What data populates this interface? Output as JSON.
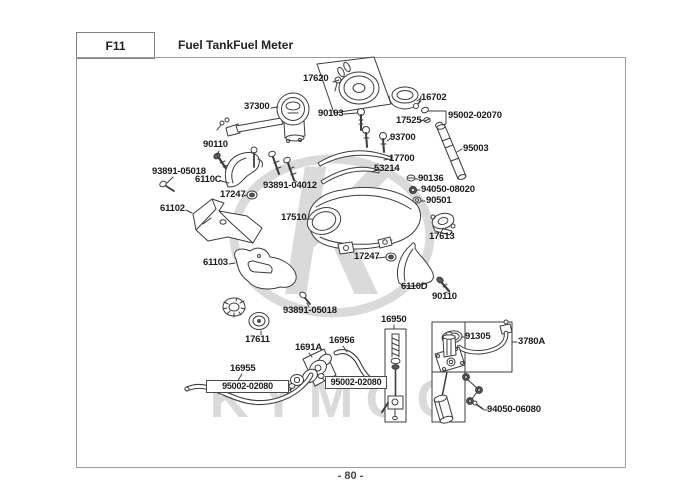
{
  "header": {
    "code": "F11",
    "title": "Fuel TankFuel Meter"
  },
  "footer": {
    "page_number": "- 80 -"
  },
  "watermark": {
    "logo_letter": "K",
    "logo_text": "KYMCO"
  },
  "colors": {
    "line": "#3c3c3c",
    "watermark": "#dadada",
    "label_text": "#1c1c1c"
  },
  "parts": [
    {
      "label": "17620"
    },
    {
      "label": "37300"
    },
    {
      "label": "90103"
    },
    {
      "label": "16702"
    },
    {
      "label": "17525"
    },
    {
      "label": "95002-02070"
    },
    {
      "label": "93700"
    },
    {
      "label": "95003"
    },
    {
      "label": "17700"
    },
    {
      "label": "53214"
    },
    {
      "label": "90136"
    },
    {
      "label": "94050-08020"
    },
    {
      "label": "90501"
    },
    {
      "label": "90110"
    },
    {
      "label": "93891-05018"
    },
    {
      "label": "6110C"
    },
    {
      "label": "93891-04012"
    },
    {
      "label": "17247"
    },
    {
      "label": "61102"
    },
    {
      "label": "17510"
    },
    {
      "label": "17613"
    },
    {
      "label": "17247"
    },
    {
      "label": "6110D"
    },
    {
      "label": "90110"
    },
    {
      "label": "61103"
    },
    {
      "label": "93891-05018"
    },
    {
      "label": "17611"
    },
    {
      "label": "16950"
    },
    {
      "label": "1691A"
    },
    {
      "label": "16956"
    },
    {
      "label": "95002-02080"
    },
    {
      "label": "95002-02080"
    },
    {
      "label": "16955"
    },
    {
      "label": "91305"
    },
    {
      "label": "3780A"
    },
    {
      "label": "94050-06080"
    }
  ]
}
